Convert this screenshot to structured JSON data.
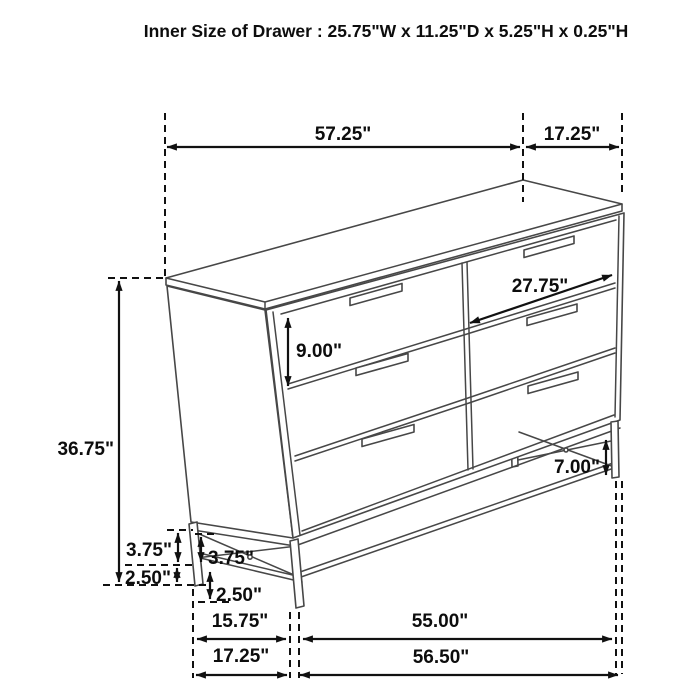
{
  "title": "Inner Size of Drawer : 25.75\"W x 11.25\"D x 5.25\"H x 0.25\"H",
  "figure": {
    "subject": "Six-drawer dresser on metal base, dimensioned perspective line drawing",
    "drawer_count": 6
  },
  "colors": {
    "background": "#ffffff",
    "line_art": "#474747",
    "dimension_lines": "#111111",
    "text": "#0d0d0d"
  },
  "labels": {
    "top_width": "57.25\"",
    "top_depth": "17.25\"",
    "drawer_front_width": "27.75\"",
    "drawer_front_height": "9.00\"",
    "overall_height": "36.75\"",
    "base_clearance": "7.00\"",
    "base_rail_outer": "3.75\"",
    "base_rail_inner": "3.75\"",
    "foot_outer": "2.50\"",
    "foot_inner": "2.50\"",
    "base_depth_inner": "15.75\"",
    "base_width_front": "55.00\"",
    "base_depth_outer": "17.25\"",
    "base_width_outer": "56.50\""
  }
}
